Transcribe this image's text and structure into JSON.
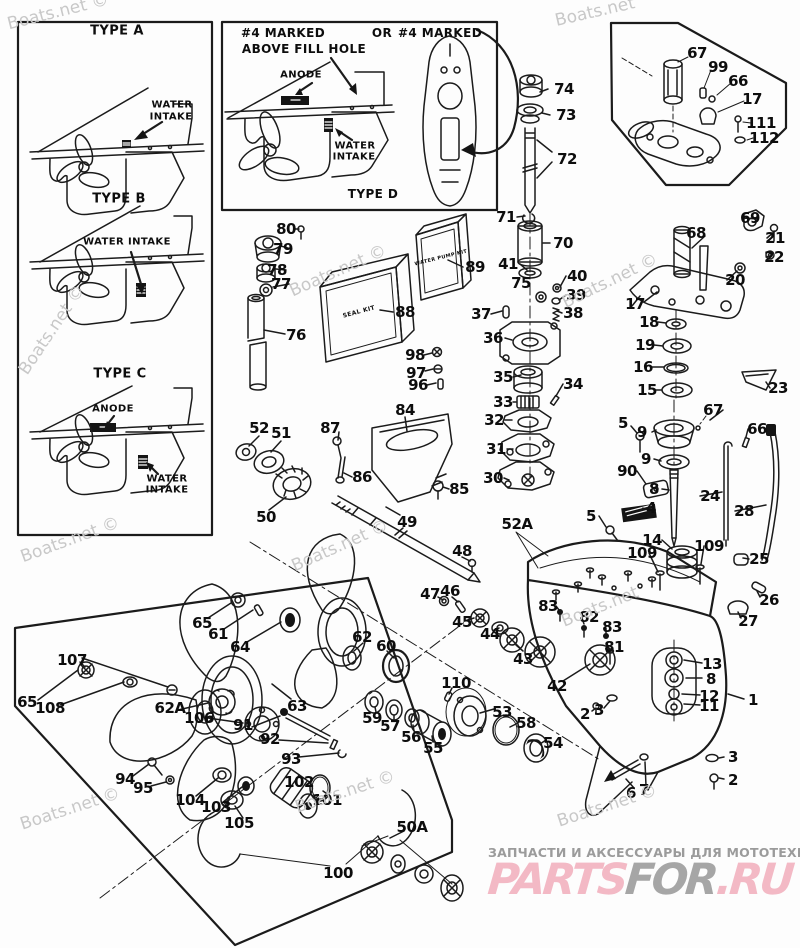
{
  "page": {
    "background": "#fdfdfd",
    "ink": "#1b1b1b",
    "watermark_color": "#c8c8c8"
  },
  "annotations": [
    {
      "text": "TYPE A",
      "x": 117,
      "y": 31,
      "size": 13
    },
    {
      "text": "WATER",
      "x": 172,
      "y": 105,
      "size": 10
    },
    {
      "text": "INTAKE",
      "x": 171,
      "y": 117,
      "size": 10
    },
    {
      "text": "TYPE B",
      "x": 119,
      "y": 199,
      "size": 13
    },
    {
      "text": "WATER INTAKE",
      "x": 127,
      "y": 242,
      "size": 10
    },
    {
      "text": "TYPE C",
      "x": 120,
      "y": 374,
      "size": 13
    },
    {
      "text": "ANODE",
      "x": 113,
      "y": 409,
      "size": 10
    },
    {
      "text": "WATER",
      "x": 167,
      "y": 479,
      "size": 10
    },
    {
      "text": "INTAKE",
      "x": 167,
      "y": 490,
      "size": 10
    },
    {
      "text": "#4 MARKED",
      "x": 283,
      "y": 33,
      "size": 12
    },
    {
      "text": "ABOVE FILL HOLE",
      "x": 304,
      "y": 49,
      "size": 12
    },
    {
      "text": "OR",
      "x": 382,
      "y": 33,
      "size": 12
    },
    {
      "text": "#4 MARKED",
      "x": 440,
      "y": 33,
      "size": 12
    },
    {
      "text": "ANODE",
      "x": 301,
      "y": 75,
      "size": 10
    },
    {
      "text": "WATER",
      "x": 355,
      "y": 146,
      "size": 10
    },
    {
      "text": "INTAKE",
      "x": 354,
      "y": 157,
      "size": 10
    },
    {
      "text": "TYPE D",
      "x": 373,
      "y": 194,
      "size": 12
    },
    {
      "text": "SEAL KIT",
      "x": 359,
      "y": 312,
      "size": 6,
      "rot": -15
    },
    {
      "text": "WATER PUMP KIT",
      "x": 441,
      "y": 258,
      "size": 5,
      "rot": -14
    }
  ],
  "callouts": [
    {
      "n": "74",
      "x": 564,
      "y": 89
    },
    {
      "n": "73",
      "x": 566,
      "y": 115
    },
    {
      "n": "72",
      "x": 567,
      "y": 159
    },
    {
      "n": "71",
      "x": 506,
      "y": 217
    },
    {
      "n": "70",
      "x": 563,
      "y": 243
    },
    {
      "n": "41",
      "x": 508,
      "y": 264
    },
    {
      "n": "75",
      "x": 521,
      "y": 283
    },
    {
      "n": "40",
      "x": 577,
      "y": 276
    },
    {
      "n": "39",
      "x": 576,
      "y": 295
    },
    {
      "n": "38",
      "x": 573,
      "y": 313
    },
    {
      "n": "37",
      "x": 481,
      "y": 314
    },
    {
      "n": "36",
      "x": 493,
      "y": 338
    },
    {
      "n": "35",
      "x": 503,
      "y": 377
    },
    {
      "n": "34",
      "x": 573,
      "y": 384
    },
    {
      "n": "33",
      "x": 503,
      "y": 402
    },
    {
      "n": "32",
      "x": 494,
      "y": 420
    },
    {
      "n": "31",
      "x": 496,
      "y": 449
    },
    {
      "n": "30",
      "x": 493,
      "y": 478
    },
    {
      "n": "80",
      "x": 286,
      "y": 229
    },
    {
      "n": "79",
      "x": 283,
      "y": 249
    },
    {
      "n": "78",
      "x": 277,
      "y": 270
    },
    {
      "n": "77",
      "x": 281,
      "y": 284
    },
    {
      "n": "76",
      "x": 296,
      "y": 335
    },
    {
      "n": "88",
      "x": 405,
      "y": 312
    },
    {
      "n": "89",
      "x": 475,
      "y": 267
    },
    {
      "n": "98",
      "x": 415,
      "y": 355
    },
    {
      "n": "97",
      "x": 416,
      "y": 373
    },
    {
      "n": "96",
      "x": 418,
      "y": 385
    },
    {
      "n": "84",
      "x": 405,
      "y": 410
    },
    {
      "n": "87",
      "x": 330,
      "y": 428
    },
    {
      "n": "86",
      "x": 362,
      "y": 477
    },
    {
      "n": "85",
      "x": 459,
      "y": 489
    },
    {
      "n": "52",
      "x": 259,
      "y": 428
    },
    {
      "n": "51",
      "x": 281,
      "y": 433
    },
    {
      "n": "50",
      "x": 266,
      "y": 517
    },
    {
      "n": "49",
      "x": 407,
      "y": 522
    },
    {
      "n": "48",
      "x": 462,
      "y": 551
    },
    {
      "n": "47",
      "x": 430,
      "y": 594
    },
    {
      "n": "46",
      "x": 450,
      "y": 591
    },
    {
      "n": "45",
      "x": 462,
      "y": 622
    },
    {
      "n": "44",
      "x": 490,
      "y": 634
    },
    {
      "n": "43",
      "x": 523,
      "y": 659
    },
    {
      "n": "52A",
      "x": 517,
      "y": 524
    },
    {
      "n": "5",
      "x": 623,
      "y": 423
    },
    {
      "n": "9",
      "x": 642,
      "y": 432
    },
    {
      "n": "9",
      "x": 646,
      "y": 459
    },
    {
      "n": "90",
      "x": 627,
      "y": 471
    },
    {
      "n": "8",
      "x": 654,
      "y": 489
    },
    {
      "n": "4",
      "x": 651,
      "y": 508
    },
    {
      "n": "5",
      "x": 591,
      "y": 516
    },
    {
      "n": "24",
      "x": 710,
      "y": 496
    },
    {
      "n": "28",
      "x": 744,
      "y": 511
    },
    {
      "n": "14",
      "x": 652,
      "y": 540
    },
    {
      "n": "109",
      "x": 642,
      "y": 553
    },
    {
      "n": "109",
      "x": 709,
      "y": 546
    },
    {
      "n": "67",
      "x": 713,
      "y": 410
    },
    {
      "n": "66",
      "x": 757,
      "y": 429
    },
    {
      "n": "25",
      "x": 759,
      "y": 559
    },
    {
      "n": "26",
      "x": 769,
      "y": 600
    },
    {
      "n": "27",
      "x": 748,
      "y": 621
    },
    {
      "n": "67",
      "x": 697,
      "y": 53
    },
    {
      "n": "99",
      "x": 718,
      "y": 67
    },
    {
      "n": "66",
      "x": 738,
      "y": 81
    },
    {
      "n": "17",
      "x": 752,
      "y": 99
    },
    {
      "n": "111",
      "x": 761,
      "y": 123
    },
    {
      "n": "112",
      "x": 764,
      "y": 138
    },
    {
      "n": "69",
      "x": 750,
      "y": 218
    },
    {
      "n": "68",
      "x": 696,
      "y": 233
    },
    {
      "n": "21",
      "x": 775,
      "y": 238
    },
    {
      "n": "22",
      "x": 774,
      "y": 257
    },
    {
      "n": "20",
      "x": 735,
      "y": 280
    },
    {
      "n": "17",
      "x": 635,
      "y": 304
    },
    {
      "n": "18",
      "x": 649,
      "y": 322
    },
    {
      "n": "19",
      "x": 645,
      "y": 345
    },
    {
      "n": "16",
      "x": 643,
      "y": 367
    },
    {
      "n": "15",
      "x": 647,
      "y": 390
    },
    {
      "n": "23",
      "x": 778,
      "y": 388
    },
    {
      "n": "83",
      "x": 548,
      "y": 606
    },
    {
      "n": "82",
      "x": 589,
      "y": 617
    },
    {
      "n": "83",
      "x": 612,
      "y": 627
    },
    {
      "n": "81",
      "x": 614,
      "y": 647
    },
    {
      "n": "42",
      "x": 557,
      "y": 686
    },
    {
      "n": "2",
      "x": 585,
      "y": 714
    },
    {
      "n": "3",
      "x": 599,
      "y": 710
    },
    {
      "n": "1",
      "x": 753,
      "y": 700
    },
    {
      "n": "13",
      "x": 712,
      "y": 664
    },
    {
      "n": "8",
      "x": 711,
      "y": 679
    },
    {
      "n": "12",
      "x": 709,
      "y": 696
    },
    {
      "n": "11",
      "x": 709,
      "y": 706
    },
    {
      "n": "3",
      "x": 733,
      "y": 757
    },
    {
      "n": "2",
      "x": 733,
      "y": 780
    },
    {
      "n": "6",
      "x": 631,
      "y": 793
    },
    {
      "n": "7",
      "x": 644,
      "y": 790
    },
    {
      "n": "110",
      "x": 456,
      "y": 683
    },
    {
      "n": "53",
      "x": 502,
      "y": 712
    },
    {
      "n": "58",
      "x": 526,
      "y": 723
    },
    {
      "n": "54",
      "x": 553,
      "y": 743
    },
    {
      "n": "55",
      "x": 433,
      "y": 748
    },
    {
      "n": "56",
      "x": 411,
      "y": 737
    },
    {
      "n": "57",
      "x": 390,
      "y": 726
    },
    {
      "n": "59",
      "x": 372,
      "y": 718
    },
    {
      "n": "60",
      "x": 386,
      "y": 646
    },
    {
      "n": "62",
      "x": 362,
      "y": 637
    },
    {
      "n": "63",
      "x": 297,
      "y": 706
    },
    {
      "n": "65",
      "x": 202,
      "y": 623
    },
    {
      "n": "61",
      "x": 218,
      "y": 634
    },
    {
      "n": "64",
      "x": 240,
      "y": 647
    },
    {
      "n": "107",
      "x": 72,
      "y": 660
    },
    {
      "n": "65",
      "x": 27,
      "y": 702
    },
    {
      "n": "108",
      "x": 50,
      "y": 708
    },
    {
      "n": "62A",
      "x": 170,
      "y": 708
    },
    {
      "n": "106",
      "x": 199,
      "y": 718
    },
    {
      "n": "91",
      "x": 243,
      "y": 725
    },
    {
      "n": "92",
      "x": 270,
      "y": 739
    },
    {
      "n": "93",
      "x": 291,
      "y": 759
    },
    {
      "n": "94",
      "x": 125,
      "y": 779
    },
    {
      "n": "95",
      "x": 143,
      "y": 788
    },
    {
      "n": "104",
      "x": 190,
      "y": 800
    },
    {
      "n": "103",
      "x": 216,
      "y": 807
    },
    {
      "n": "105",
      "x": 239,
      "y": 823
    },
    {
      "n": "102",
      "x": 299,
      "y": 782
    },
    {
      "n": "101",
      "x": 327,
      "y": 800
    },
    {
      "n": "100",
      "x": 338,
      "y": 873
    },
    {
      "n": "50A",
      "x": 412,
      "y": 827
    }
  ],
  "watermarks": [
    {
      "text": "Boats.net ©",
      "x": 58,
      "y": 12,
      "rot": -14
    },
    {
      "text": "Boats.net",
      "x": 595,
      "y": 12,
      "rot": -13
    },
    {
      "text": "Boats.net ©",
      "x": 338,
      "y": 271,
      "rot": -24
    },
    {
      "text": "Boats.net ©",
      "x": 52,
      "y": 330,
      "rot": -56
    },
    {
      "text": "Boats.net ©",
      "x": 340,
      "y": 546,
      "rot": -24
    },
    {
      "text": "Boats.net ©",
      "x": 610,
      "y": 281,
      "rot": -26
    },
    {
      "text": "Boats.net ©",
      "x": 70,
      "y": 540,
      "rot": -20
    },
    {
      "text": "Boats.net",
      "x": 600,
      "y": 607,
      "rot": -22
    },
    {
      "text": "Boats.net ©",
      "x": 607,
      "y": 806,
      "rot": -18
    },
    {
      "text": "Boats.net ©",
      "x": 70,
      "y": 809,
      "rot": -18
    },
    {
      "text": "Boats.net ©",
      "x": 345,
      "y": 792,
      "rot": -18
    }
  ],
  "footer": {
    "tagline": "ЗАПЧАСТИ И АКСЕССУАРЫ ДЛЯ МОТОТЕХНИКИ",
    "brand_parts": "PARTS",
    "brand_for": "FOR",
    "brand_ru": ".RU",
    "pink": "#f3b9c5",
    "gray": "#a6a6a6"
  }
}
